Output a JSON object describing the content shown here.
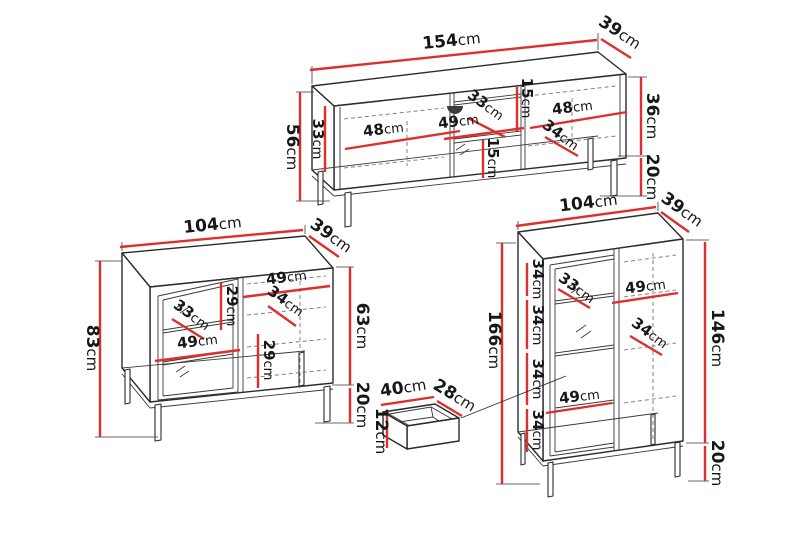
{
  "unit": "cm",
  "colors": {
    "dimension_red": "#dd2f2b",
    "drawing_black": "#2b2b2b"
  },
  "pieces": {
    "tv_stand": {
      "width": "154",
      "depth": "39",
      "total_height": "56",
      "body_height": "36",
      "leg_height": "20",
      "interior": {
        "left_width": "48",
        "left_height": "33",
        "center_width": "49",
        "center_depth": "33",
        "center_top_height": "15",
        "center_bottom_height": "15",
        "right_width": "48",
        "right_depth": "34"
      }
    },
    "sideboard": {
      "width": "104",
      "depth": "39",
      "total_height": "83",
      "body_height": "63",
      "leg_height": "20",
      "interior": {
        "top_right_width": "49",
        "right_depth": "34",
        "upper_shelf_height": "29",
        "left_depth": "33",
        "left_width": "49",
        "lower_shelf_height": "29"
      }
    },
    "tall_cabinet": {
      "width": "104",
      "depth": "39",
      "total_height": "166",
      "body_height": "146",
      "leg_height": "20",
      "interior": {
        "shelf1_height": "34",
        "shelf2_height": "34",
        "shelf3_height": "34",
        "shelf4_height": "34",
        "left_depth": "33",
        "top_right_width": "49",
        "right_depth": "34",
        "bottom_left_width": "49"
      }
    },
    "drawer": {
      "width": "40",
      "depth": "28",
      "height": "12"
    }
  }
}
